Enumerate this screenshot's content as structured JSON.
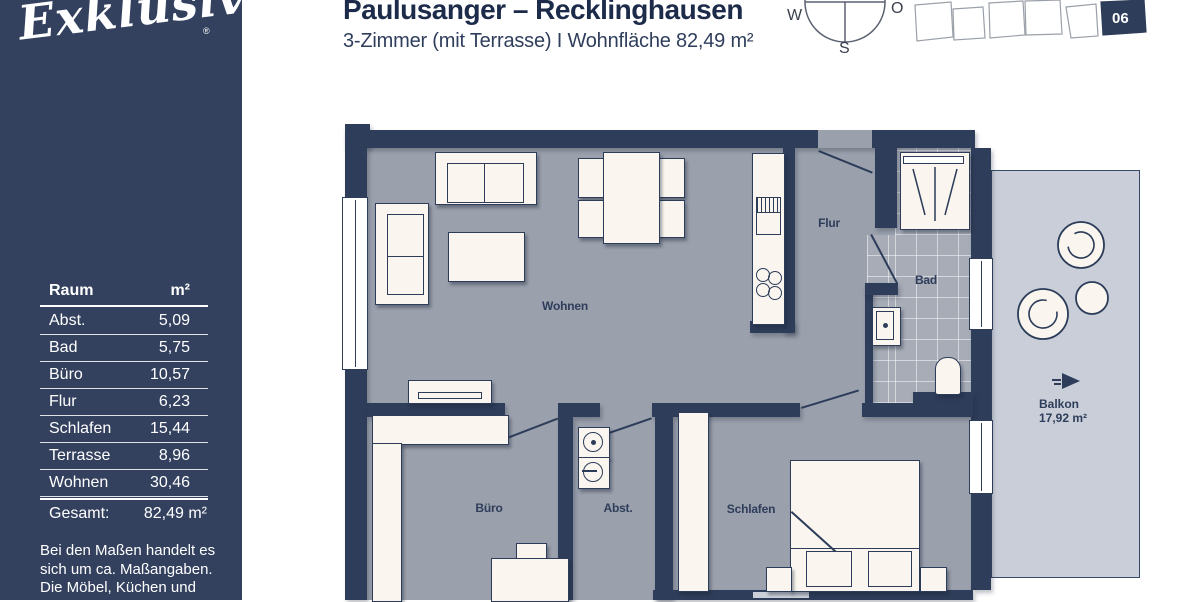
{
  "colors": {
    "sidebar_bg": "#33415f",
    "wall": "#2e3d5a",
    "floor": "#9aa0ac",
    "bath_tiles": "#a7acb7",
    "balcony": "#c9ced8",
    "furniture": "#faf6ef",
    "title_text": "#1d2b4a",
    "white": "#ffffff"
  },
  "sidebar": {
    "logo": "Exklusiv",
    "registered": "®",
    "table": {
      "headers": {
        "room": "Raum",
        "area": "m²"
      },
      "rows": [
        {
          "name": "Abst.",
          "value": "5,09"
        },
        {
          "name": "Bad",
          "value": "5,75"
        },
        {
          "name": "Büro",
          "value": "10,57"
        },
        {
          "name": "Flur",
          "value": "6,23"
        },
        {
          "name": "Schlafen",
          "value": "15,44"
        },
        {
          "name": "Terrasse",
          "value": "8,96"
        },
        {
          "name": "Wohnen",
          "value": "30,46"
        }
      ],
      "total": {
        "name": "Gesamt:",
        "value": "82,49 m²"
      }
    },
    "disclaimer": {
      "line1": "Bei den Maßen handelt es",
      "line2": "sich um ca. Maßangaben.",
      "line3": "Die Möbel, Küchen und",
      "line4": "Sanitärobjekte sind"
    }
  },
  "header": {
    "title": "Paulusanger – Recklinghausen",
    "subtitle": "3-Zimmer (mit Terrasse) I Wohnfläche 82,49 m²"
  },
  "compass": {
    "west": "W",
    "east": "O",
    "south": "S"
  },
  "siteplan": {
    "unit_number": "06"
  },
  "floorplan": {
    "rooms": {
      "wohnen": "Wohnen",
      "flur": "Flur",
      "bad": "Bad",
      "buero": "Büro",
      "abst": "Abst.",
      "schlafen": "Schlafen"
    },
    "balcony": {
      "label": "Balkon",
      "area": "17,92 m²"
    }
  }
}
